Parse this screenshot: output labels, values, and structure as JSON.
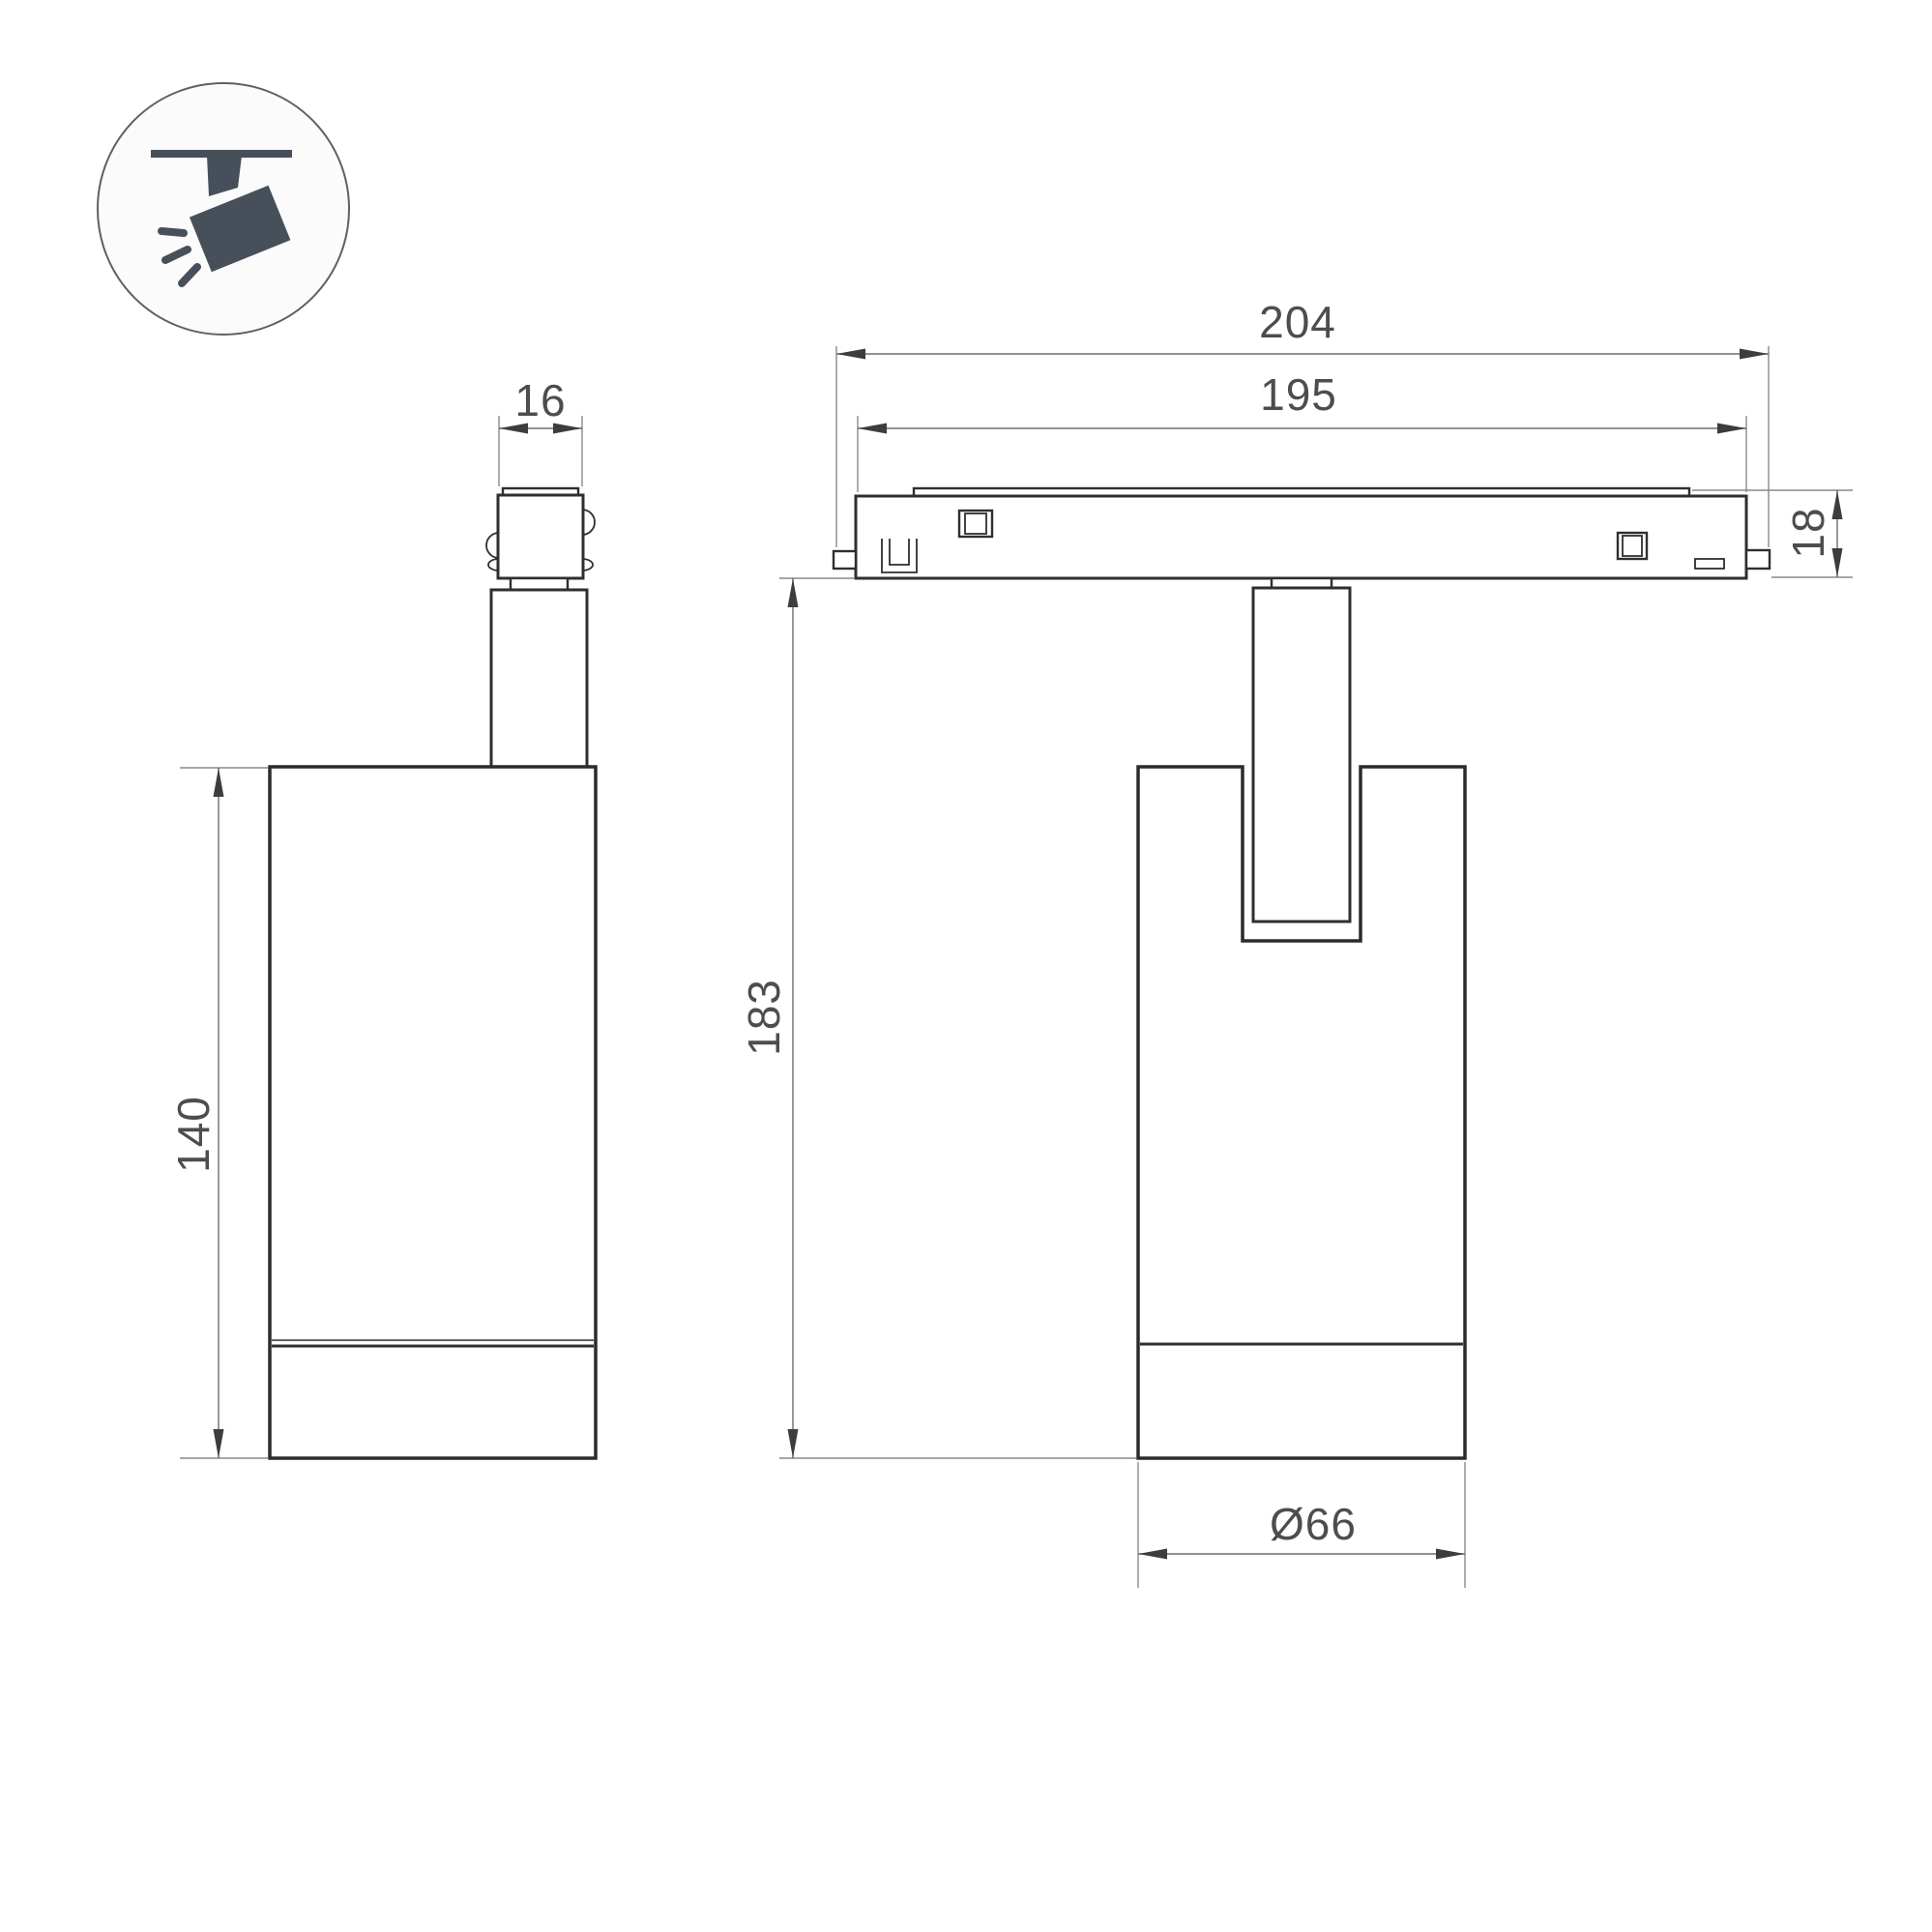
{
  "drawing_type": "luminaire dimension drawing",
  "colors": {
    "background": "#ffffff",
    "outline": "#2f2f2f",
    "dimension_line": "#6e6e6e",
    "extension_line": "#8a8a8a",
    "arrowhead": "#3d3d3d",
    "dimension_text": "#4d4d4d",
    "icon_fill": "#47505a",
    "icon_circle_border": "#606060"
  },
  "icon": {
    "name": "ceiling-track-spotlight-icon"
  },
  "dims": {
    "width16": "16",
    "height140": "140",
    "width204": "204",
    "width195": "195",
    "height18": "18",
    "height183": "183",
    "diameter66": "Ø66"
  }
}
